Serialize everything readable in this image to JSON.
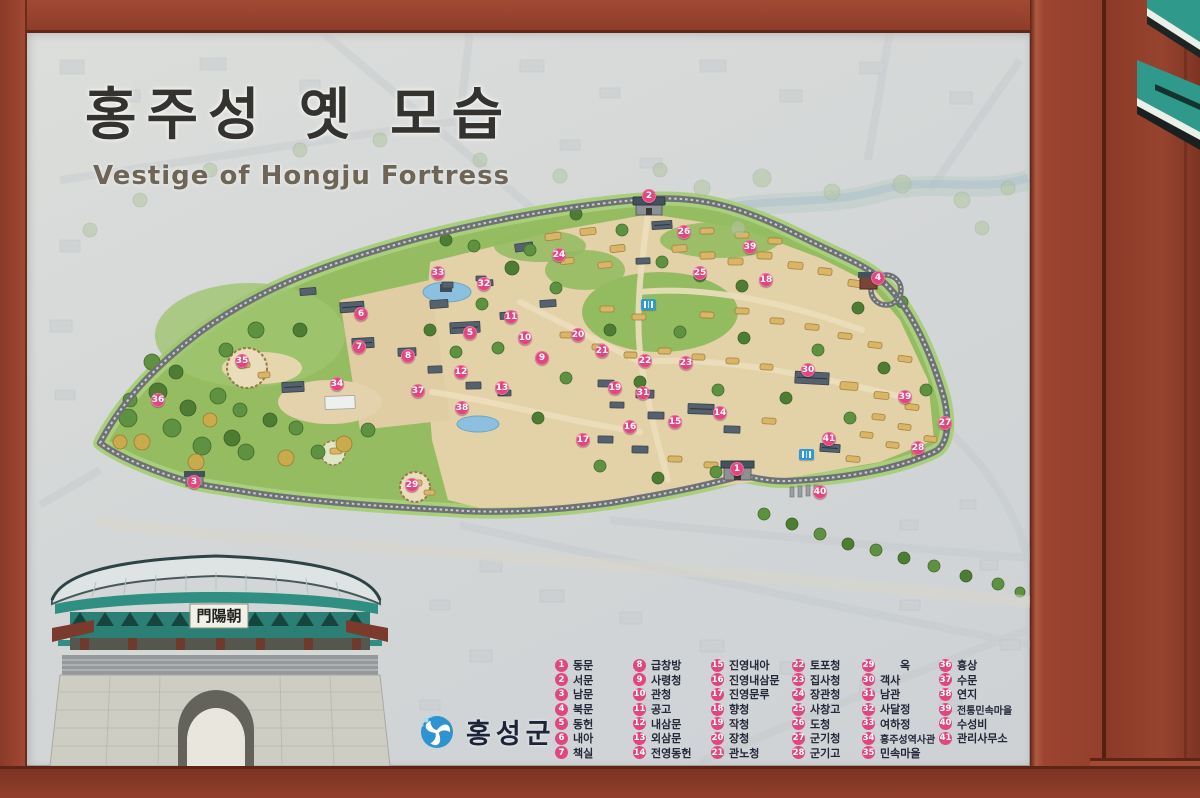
{
  "sign": {
    "title_korean": "홍주성 옛 모습",
    "title_english": "Vestige of Hongju Fortress",
    "organization": "홍성군",
    "gate_plaque": "門陽朝"
  },
  "legend": {
    "items": [
      {
        "n": 1,
        "label": "동문"
      },
      {
        "n": 2,
        "label": "서문"
      },
      {
        "n": 3,
        "label": "남문"
      },
      {
        "n": 4,
        "label": "북문"
      },
      {
        "n": 5,
        "label": "동헌"
      },
      {
        "n": 6,
        "label": "내아"
      },
      {
        "n": 7,
        "label": "책실"
      },
      {
        "n": 8,
        "label": "급창방"
      },
      {
        "n": 9,
        "label": "사령청"
      },
      {
        "n": 10,
        "label": "관청"
      },
      {
        "n": 11,
        "label": "공고"
      },
      {
        "n": 12,
        "label": "내삼문"
      },
      {
        "n": 13,
        "label": "외삼문"
      },
      {
        "n": 14,
        "label": "전영동헌"
      },
      {
        "n": 15,
        "label": "진영내아"
      },
      {
        "n": 16,
        "label": "진영내삼문"
      },
      {
        "n": 17,
        "label": "진영문루"
      },
      {
        "n": 18,
        "label": "향청"
      },
      {
        "n": 19,
        "label": "작청"
      },
      {
        "n": 20,
        "label": "장청"
      },
      {
        "n": 21,
        "label": "관노청"
      },
      {
        "n": 22,
        "label": "토포청"
      },
      {
        "n": 23,
        "label": "집사청"
      },
      {
        "n": 24,
        "label": "장관청"
      },
      {
        "n": 25,
        "label": "사창고"
      },
      {
        "n": 26,
        "label": "도청"
      },
      {
        "n": 27,
        "label": "군기청"
      },
      {
        "n": 28,
        "label": "군기고"
      },
      {
        "n": 29,
        "label": "옥"
      },
      {
        "n": 30,
        "label": "객사"
      },
      {
        "n": 31,
        "label": "남관"
      },
      {
        "n": 32,
        "label": "사달정"
      },
      {
        "n": 33,
        "label": "여하정"
      },
      {
        "n": 34,
        "label": "홍주성역사관"
      },
      {
        "n": 35,
        "label": "민속마을"
      },
      {
        "n": 36,
        "label": "흉상"
      },
      {
        "n": 37,
        "label": "수문"
      },
      {
        "n": 38,
        "label": "연지"
      },
      {
        "n": 39,
        "label": "전통민속마을"
      },
      {
        "n": 40,
        "label": "수성비"
      },
      {
        "n": 41,
        "label": "관리사무소"
      }
    ]
  },
  "map": {
    "markers": [
      {
        "n": 1,
        "x": 737,
        "y": 469
      },
      {
        "n": 2,
        "x": 649,
        "y": 196
      },
      {
        "n": 3,
        "x": 194,
        "y": 482
      },
      {
        "n": 4,
        "x": 878,
        "y": 278
      },
      {
        "n": 5,
        "x": 470,
        "y": 333
      },
      {
        "n": 6,
        "x": 361,
        "y": 314
      },
      {
        "n": 7,
        "x": 359,
        "y": 347
      },
      {
        "n": 8,
        "x": 408,
        "y": 356
      },
      {
        "n": 9,
        "x": 542,
        "y": 358
      },
      {
        "n": 10,
        "x": 525,
        "y": 338
      },
      {
        "n": 11,
        "x": 511,
        "y": 317
      },
      {
        "n": 12,
        "x": 461,
        "y": 372
      },
      {
        "n": 13,
        "x": 502,
        "y": 388
      },
      {
        "n": 14,
        "x": 720,
        "y": 413
      },
      {
        "n": 15,
        "x": 675,
        "y": 422
      },
      {
        "n": 16,
        "x": 630,
        "y": 427
      },
      {
        "n": 17,
        "x": 583,
        "y": 440
      },
      {
        "n": 18,
        "x": 766,
        "y": 280
      },
      {
        "n": 19,
        "x": 615,
        "y": 388
      },
      {
        "n": 20,
        "x": 578,
        "y": 335
      },
      {
        "n": 21,
        "x": 602,
        "y": 351
      },
      {
        "n": 22,
        "x": 645,
        "y": 361
      },
      {
        "n": 23,
        "x": 686,
        "y": 363
      },
      {
        "n": 24,
        "x": 559,
        "y": 255
      },
      {
        "n": 25,
        "x": 700,
        "y": 273
      },
      {
        "n": 26,
        "x": 684,
        "y": 232
      },
      {
        "n": 27,
        "x": 945,
        "y": 423
      },
      {
        "n": 28,
        "x": 918,
        "y": 448
      },
      {
        "n": 29,
        "x": 412,
        "y": 485
      },
      {
        "n": 30,
        "x": 808,
        "y": 370
      },
      {
        "n": 31,
        "x": 643,
        "y": 393
      },
      {
        "n": 32,
        "x": 484,
        "y": 284
      },
      {
        "n": 33,
        "x": 438,
        "y": 273
      },
      {
        "n": 34,
        "x": 337,
        "y": 384
      },
      {
        "n": 35,
        "x": 242,
        "y": 361
      },
      {
        "n": 36,
        "x": 158,
        "y": 400
      },
      {
        "n": 37,
        "x": 418,
        "y": 391
      },
      {
        "n": 38,
        "x": 462,
        "y": 408
      },
      {
        "n": 39,
        "x": 750,
        "y": 247
      },
      {
        "n": 39,
        "x": 905,
        "y": 397
      },
      {
        "n": 40,
        "x": 820,
        "y": 492
      },
      {
        "n": 41,
        "x": 829,
        "y": 439
      }
    ],
    "restroom_icons": [
      {
        "x": 648,
        "y": 304
      },
      {
        "x": 806,
        "y": 454
      }
    ]
  },
  "colors": {
    "frame_red": "#96422f",
    "marker_pink": "#e2467f",
    "fortress_green": "#96bc62",
    "wall_gray": "#6e7276",
    "logo_blue": "#2e93cf",
    "roof_teal": "#2f8f82"
  }
}
